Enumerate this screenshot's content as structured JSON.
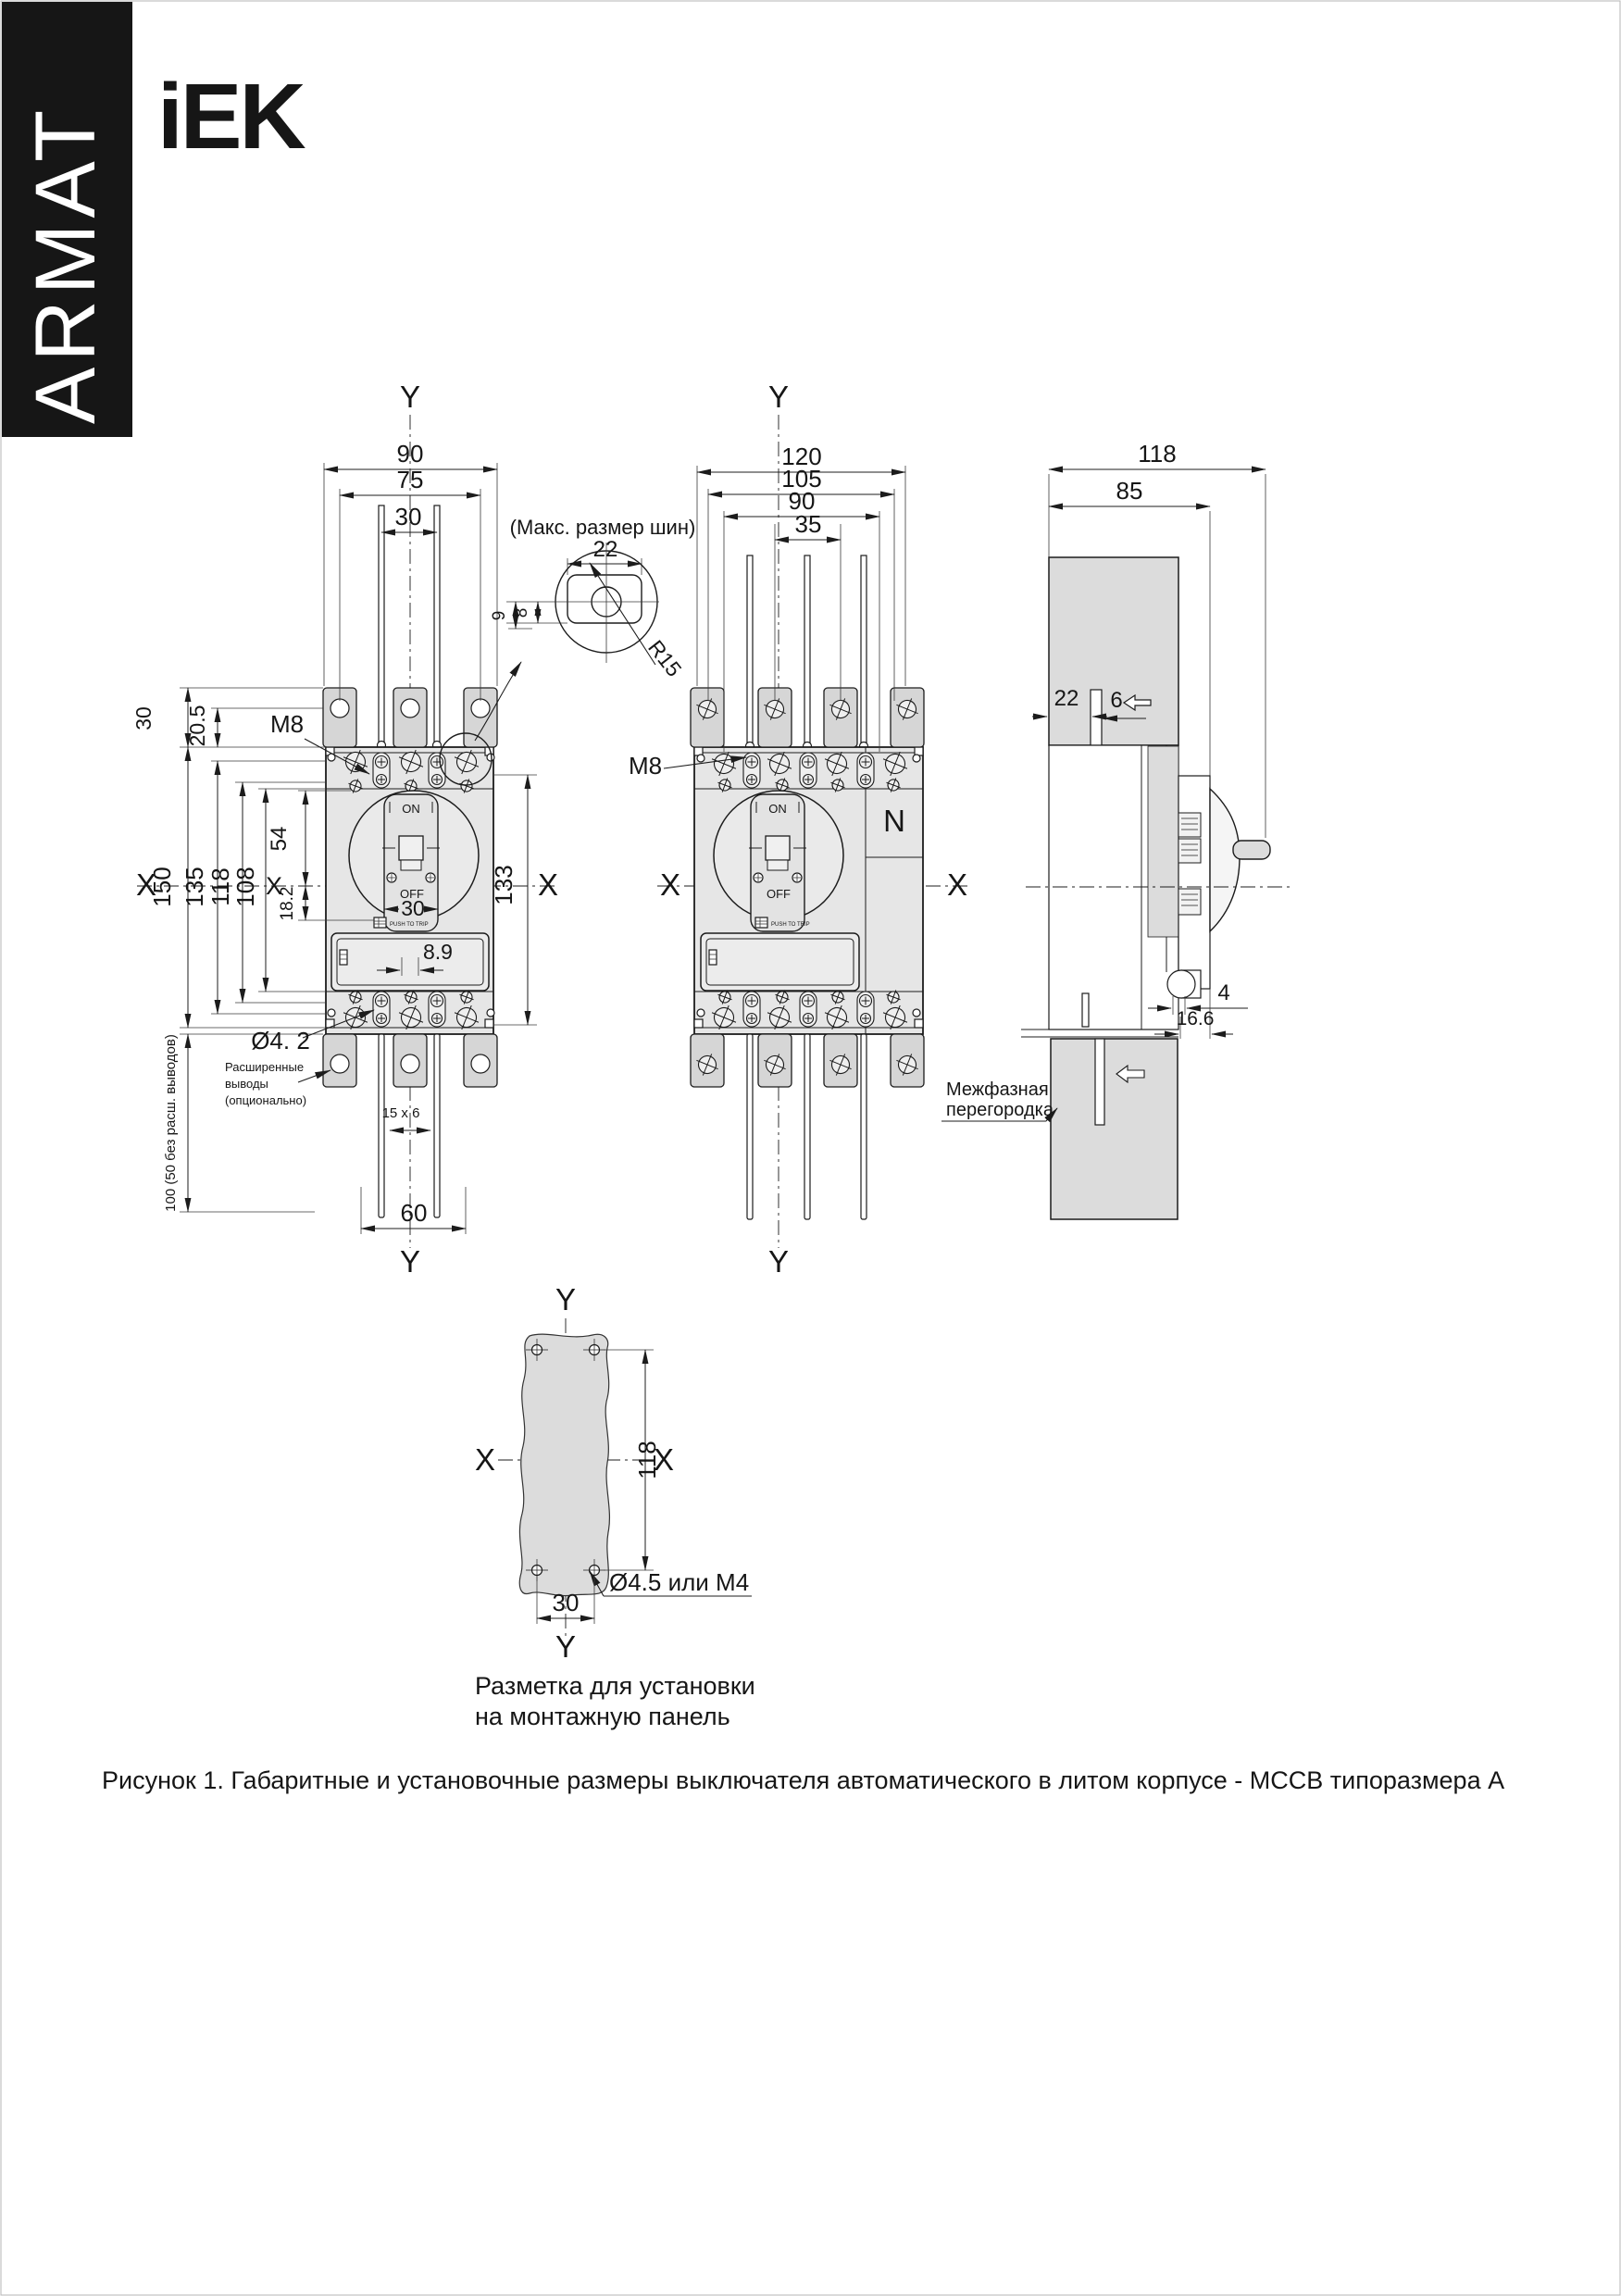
{
  "page": {
    "figure_caption": "Рисунок 1. Габаритные и установочные размеры выключателя автоматического в литом корпусе - MCCB типоразмера А"
  },
  "brand": {
    "banner": "ARMAT",
    "logo": "iEK"
  },
  "view3p": {
    "axis": {
      "y_top": "Y",
      "y_bottom": "Y",
      "x_left": "X",
      "x_left2": "X",
      "x_right": "X"
    },
    "top_dims": {
      "d90": "90",
      "d75": "75",
      "d30": "30"
    },
    "left_dims": {
      "d30": "30",
      "d205": "20.5",
      "d150": "150",
      "d135": "135",
      "d118": "118",
      "d108": "108",
      "d54": "54",
      "d182": "18.2",
      "d100": "100 (50 без расш. выводов)"
    },
    "right_dims": {
      "d133": "133"
    },
    "bottom_dims": {
      "d60": "60",
      "d15x6": "15 x 6"
    },
    "callouts": {
      "m8": "M8",
      "dia": "Ø4. 2",
      "ext1": "Расширенные",
      "ext2": "выводы",
      "ext3": "(опционально)"
    },
    "device": {
      "on": "ON",
      "off": "OFF",
      "push": "PUSH TO TRIP",
      "toggle_d30": "30",
      "d89": "8.9"
    }
  },
  "bus_detail": {
    "title": "(Макс. размер шин)",
    "d22": "22",
    "d9": "9",
    "d8": "8",
    "r15": "R15"
  },
  "view4p": {
    "axis": {
      "y_top": "Y",
      "y_bottom": "Y",
      "x_left": "X",
      "x_right": "X"
    },
    "top_dims": {
      "d120": "120",
      "d105": "105",
      "d90": "90",
      "d35": "35"
    },
    "callouts": {
      "m8": "M8",
      "n": "N",
      "partition1": "Межфазная",
      "partition2": "перегородка"
    },
    "device": {
      "on": "ON",
      "off": "OFF",
      "push": "PUSH TO TRIP"
    }
  },
  "viewside": {
    "dims": {
      "d118": "118",
      "d85": "85",
      "d22": "22",
      "d6": "6",
      "d4": "4",
      "d166": "16.6"
    }
  },
  "viewtpl": {
    "axis": {
      "y_top": "Y",
      "y_bottom": "Y",
      "x_left": "X",
      "x_right": "X"
    },
    "dims": {
      "d118": "118",
      "d30": "30"
    },
    "hole_label": "Ø4.5 или М4",
    "caption1": "Разметка для установки",
    "caption2": "на монтажную панель"
  }
}
